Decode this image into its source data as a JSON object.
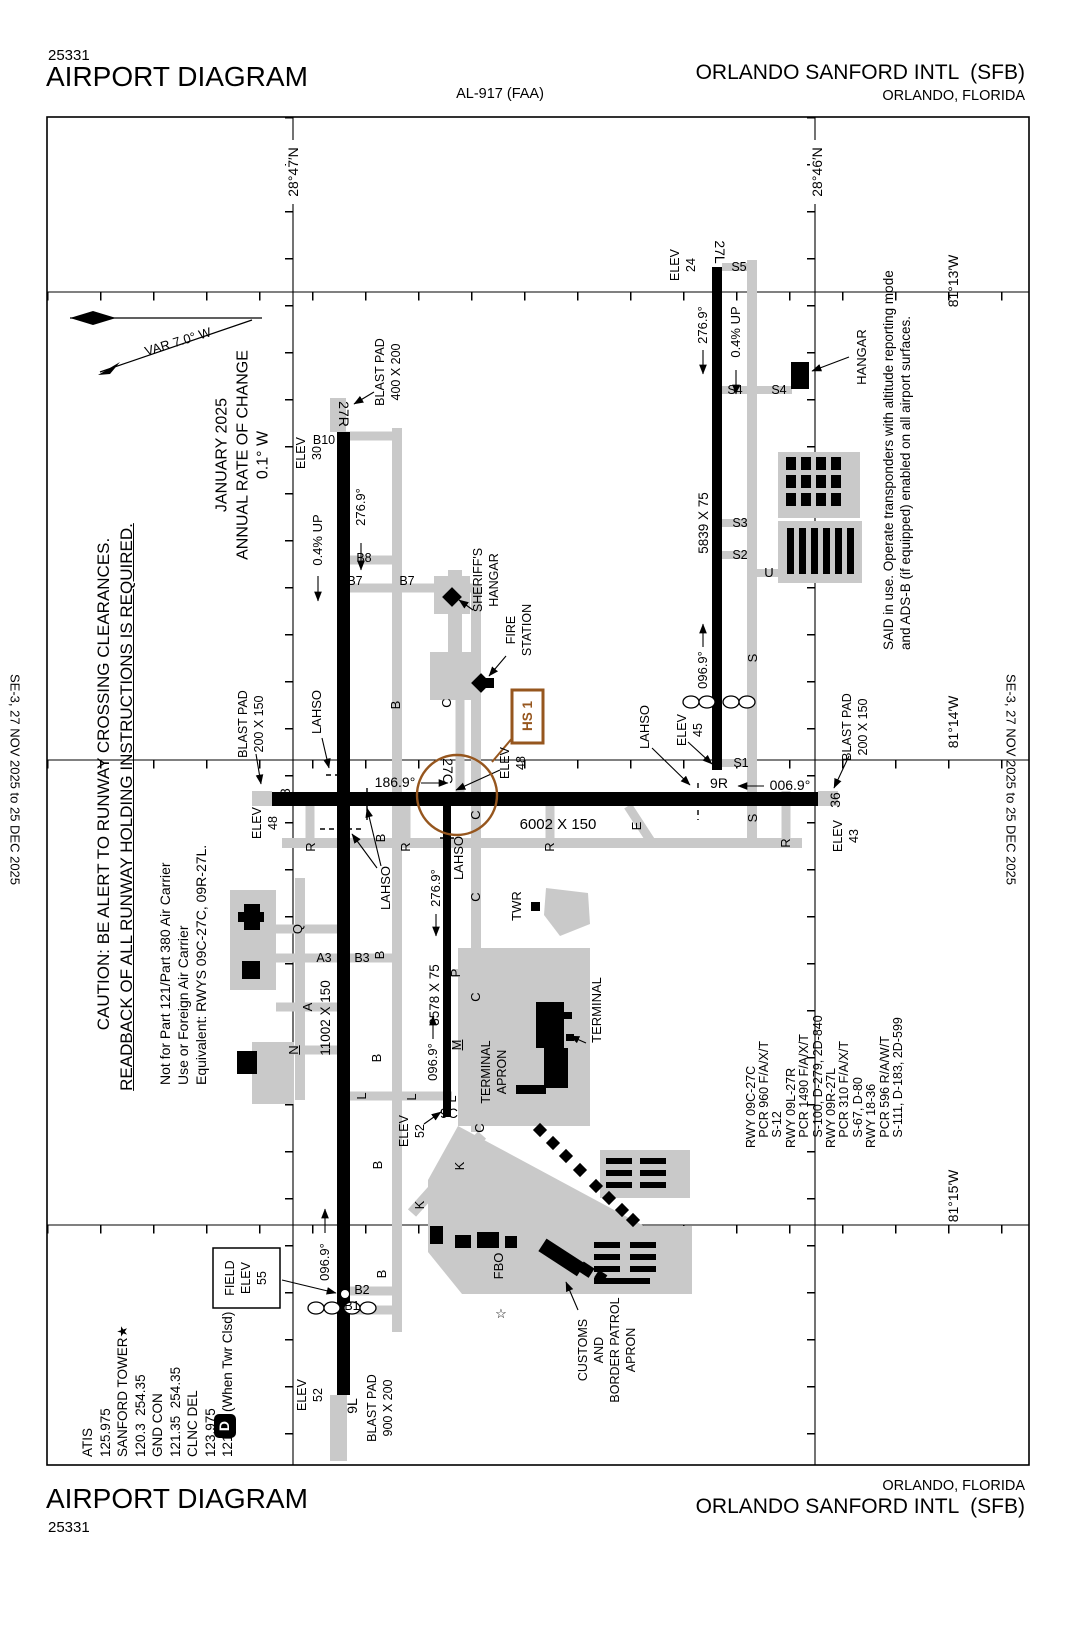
{
  "colors": {
    "hot_spot_brown": "#96561E",
    "taxiway_gray": "#C9C9C9",
    "ink": "#000000"
  },
  "header": {
    "chart_code": "25331",
    "title": "AIRPORT DIAGRAM",
    "procedure_id": "AL-917 (FAA)",
    "airport_name": "ORLANDO SANFORD INTL  (SFB)",
    "city": "ORLANDO, FLORIDA"
  },
  "footer": {
    "title": "AIRPORT DIAGRAM",
    "chart_code": "25331",
    "city": "ORLANDO, FLORIDA",
    "airport_name": "ORLANDO SANFORD INTL  (SFB)"
  },
  "margin": {
    "effective_dates": "SE-3, 27 NOV 2025 to 25 DEC 2025"
  },
  "graticule": {
    "lat1": "28°47′N",
    "lat2": "28°46′N",
    "lon1": "81°13′W",
    "lon2": "81°14′W",
    "lon3": "81°15′W"
  },
  "notes": {
    "variation": "VAR 7.0° W",
    "rate_of_change": "JANUARY 2025\nANNUAL RATE OF CHANGE\n0.1° W",
    "caution": "CAUTION: BE ALERT TO RUNWAY CROSSING CLEARANCES.",
    "caution_underlined": "READBACK OF ALL RUNWAY HOLDING INSTRUCTIONS IS REQUIRED.",
    "part121": "Not for Part 121/Part 380 Air Carrier\nUse or Foreign Air Carrier\nEquivalent: RWYS 09C-27C, 09R-27L.",
    "said": "SAID in use. Operate transponders with altitude reporting mode\nand ADS-B (if equipped) enabled on all airport surfaces."
  },
  "comms": {
    "block": "ATIS\n125.975\nSANFORD TOWER★\n120.3  254.35\nGND CON\n121.35  254.35\nCLNC DEL\n123.975\n121.35 (When Twr Clsd)",
    "weather_symbol": "D"
  },
  "runway_data_block": "RWY 09C-27C\n   PCR 960 F/A/X/T\n   S-12\nRWY 09L-27R\n   PCR 1490 F/A/X/T\n   S-100, D-279, 2D-840\nRWY 09R-27L\n   PCR 310 F/A/X/T\n   S-67, D-80\nRWY 18-36\n   PCR 596 R/A/W/T\n   S-111, D-183, 2D-599",
  "runways": {
    "r9l_27r": {
      "end_27r": "27R",
      "end_9l": "9L",
      "dimensions": "11002 X 150",
      "hdg_27r": "276.9°",
      "hdg_9l": "096.9°",
      "gradient": "0.4% UP",
      "elev_27r": "ELEV\n30",
      "elev_9l": "ELEV\n52"
    },
    "r9c_27c": {
      "end_27c": "27C",
      "end_9c": "9C",
      "dimensions": "3578 X 75",
      "hdg_27c": "276.9°",
      "hdg_9c": "096.9°",
      "elev_27c": "ELEV\n48",
      "elev_9c": "ELEV\n52"
    },
    "r9r_27l": {
      "end_27l": "27L",
      "end_9r": "9R",
      "dimensions": "5839 X 75",
      "hdg_27l": "276.9°",
      "hdg_9r": "096.9°",
      "gradient": "0.4% UP",
      "elev_27l": "ELEV\n24",
      "elev_9r": "ELEV\n45"
    },
    "r18_36": {
      "end_18": "18",
      "end_36": "36",
      "dimensions": "6002 X 150",
      "hdg_18": "186.9°",
      "hdg_36": "006.9°",
      "elev_18": "ELEV\n48",
      "elev_36": "ELEV\n43"
    }
  },
  "blast_pads": {
    "rwy27r": "BLAST PAD\n400 X 200",
    "rwy18": "BLAST PAD\n200 X 150",
    "rwy36": "BLAST PAD\n200 X 150",
    "rwy9l": "BLAST PAD\n900 X 200"
  },
  "field_elevation": {
    "label": "FIELD\nELEV\n55"
  },
  "hot_spots": {
    "hs1": "HS 1"
  },
  "lahso_label": "LAHSO",
  "facilities": {
    "hangar": "HANGAR",
    "sheriffs_hangar": "SHERIFF'S\nHANGAR",
    "fire_station": "FIRE\nSTATION",
    "tower": "TWR",
    "terminal": "TERMINAL",
    "terminal_apron": "TERMINAL\nAPRON",
    "fbo": "FBO",
    "customs_apron": "CUSTOMS\nAND\nBORDER PATROL\nAPRON",
    "beacon_symbol": "☆"
  },
  "taxiways": {
    "a": "A",
    "b": "B",
    "c": "C",
    "e": "E",
    "k": "K",
    "l": "L",
    "m": "M",
    "n": "N",
    "p": "P",
    "q": "Q",
    "r": "R",
    "s": "S",
    "u": "U",
    "a3": "A3",
    "b1": "B1",
    "b2": "B2",
    "b3": "B3",
    "b7": "B7",
    "b8": "B8",
    "b10": "B10",
    "s1": "S1",
    "s2": "S2",
    "s3": "S3",
    "s4": "S4",
    "s5": "S5"
  }
}
